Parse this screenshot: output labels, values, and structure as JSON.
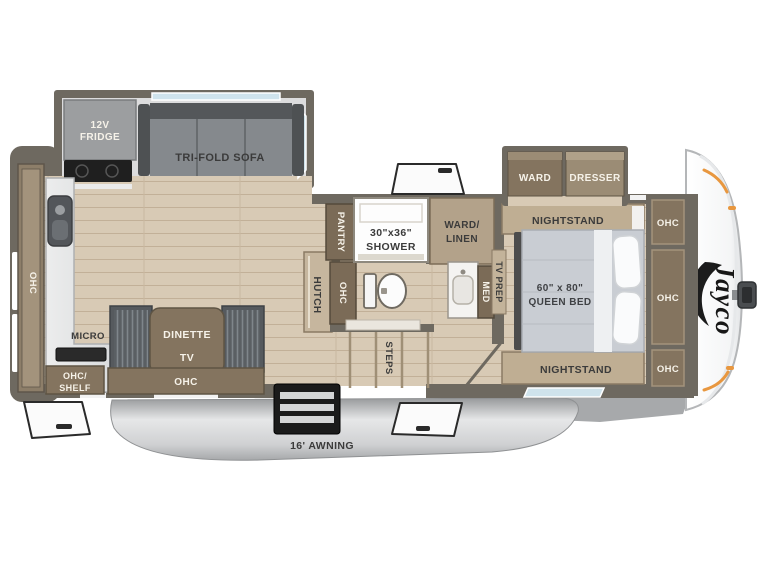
{
  "title": "Fifth wheel RV floor plan",
  "brand": {
    "logo_text": "Jayco"
  },
  "colors": {
    "floor": "#d8cab5",
    "wall": "#6e6960",
    "cabinet_dark": "#84745f",
    "cabinet_light": "#bfae93",
    "counter": "#e2e3e4",
    "awning_silver": "#c9cacc",
    "accent_orange": "#e8973f",
    "window_blue": "#cfe3ec",
    "text_dark": "#3b3b3b",
    "text_light": "#f6f2e9"
  },
  "kitchen": {
    "fridge_line1": "12V",
    "fridge_line2": "FRIDGE",
    "micro_label": "MICRO",
    "rear_ohc_label": "OHC"
  },
  "living": {
    "sofa_label": "TRI-FOLD SOFA",
    "dinette_label": "DINETTE",
    "dinette_tv_label": "TV",
    "hutch_label": "HUTCH",
    "ohc_shelf_line1": "OHC/",
    "ohc_shelf_line2": "SHELF",
    "ohc_label": "OHC"
  },
  "bath": {
    "pantry_label": "PANTRY",
    "pantry_ohc_label": "OHC",
    "shower_line1": "30\"x36\"",
    "shower_line2": "SHOWER",
    "ward_linen_line1": "WARD/",
    "ward_linen_line2": "LINEN",
    "med_label": "MED",
    "steps_label": "STEPS"
  },
  "bedroom": {
    "tv_prep_label": "TV PREP",
    "nightstand_top_label": "NIGHTSTAND",
    "nightstand_bottom_label": "NIGHTSTAND",
    "bed_line1": "60\" x 80\"",
    "bed_line2": "QUEEN BED",
    "ward_label": "WARD",
    "dresser_label": "DRESSER",
    "ohc_top_label": "OHC",
    "ohc_mid_label": "OHC",
    "ohc_bottom_label": "OHC"
  },
  "exterior": {
    "awning_label": "16' AWNING"
  }
}
